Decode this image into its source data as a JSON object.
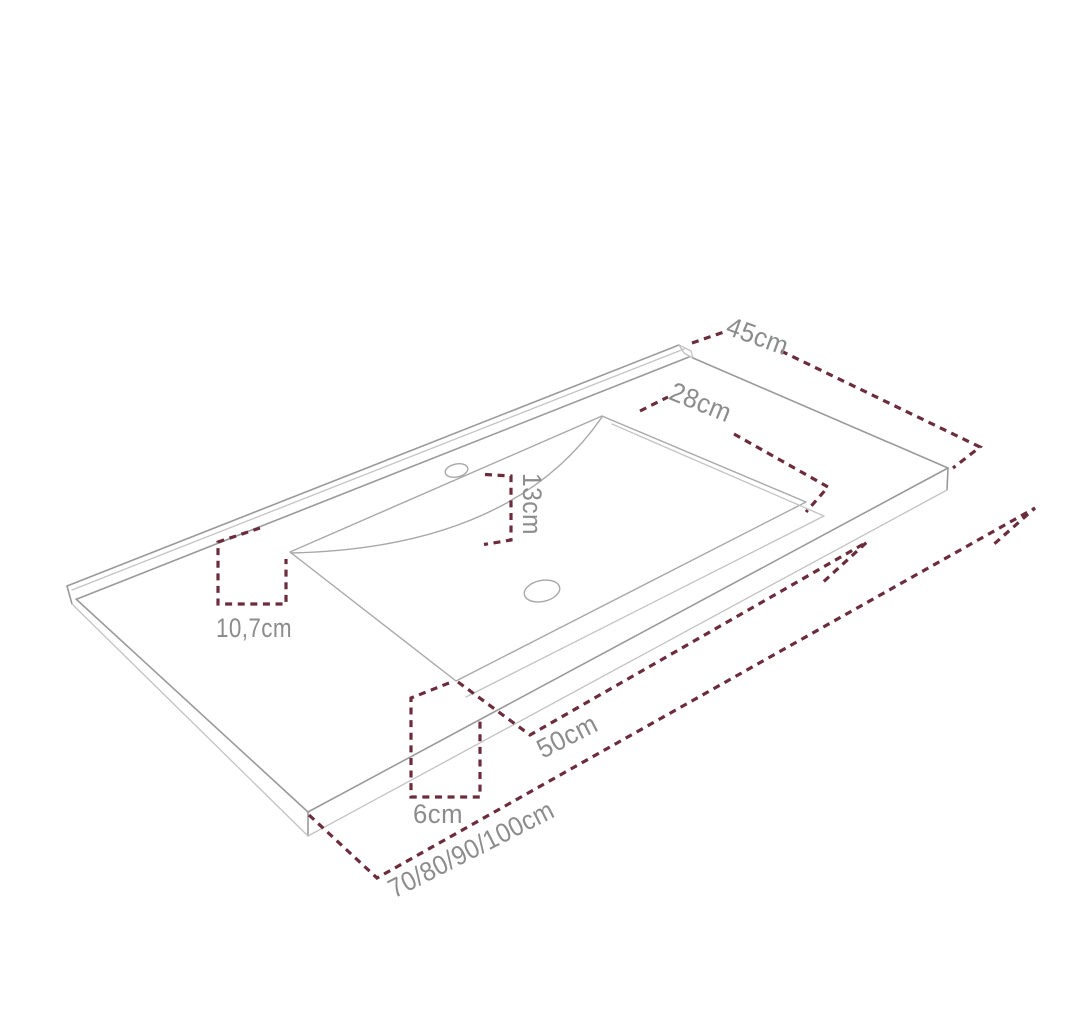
{
  "diagram": {
    "title": "washbasin countertop dimension drawing",
    "type": "isometric technical diagram",
    "units": "cm",
    "dimensions": [
      {
        "id": "countertop-depth",
        "label": "45cm"
      },
      {
        "id": "basin-depth",
        "label": "28cm"
      },
      {
        "id": "basin-back-offset",
        "label": "13cm"
      },
      {
        "id": "back-ledge-depth",
        "label": "10,7cm"
      },
      {
        "id": "basin-width",
        "label": "50cm"
      },
      {
        "id": "front-edge-offset",
        "label": "6cm"
      },
      {
        "id": "countertop-width-options",
        "label": "70/80/90/100cm"
      }
    ],
    "features": {
      "tap_hole": "single tap hole on back deck",
      "drain_hole": "center drain hole in basin"
    },
    "colors": {
      "dimension_line": "#6b2c3d",
      "label_text": "#8c8c8c",
      "drawing_line": "#9a9a9a",
      "background": "#ffffff"
    }
  }
}
